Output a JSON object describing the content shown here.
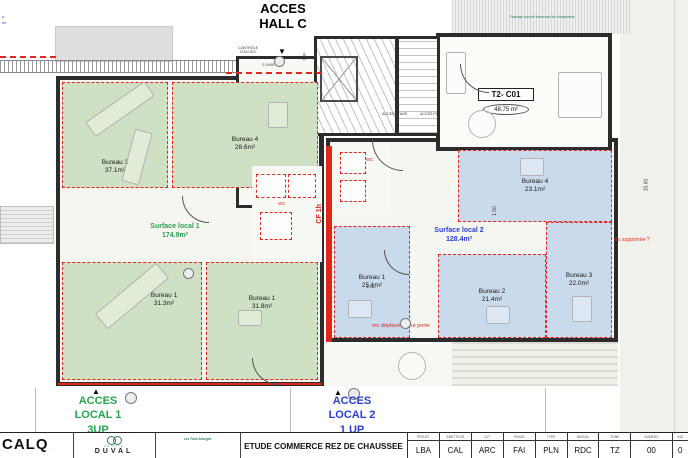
{
  "icons": {
    "down_arrow": "▼",
    "up_arrow": "▲"
  },
  "header": {
    "line1": "ACCES",
    "line2": "HALL C"
  },
  "notes": {
    "corner": [
      "s",
      "rie"
    ],
    "passage": "Passage couvert traversant de chargement"
  },
  "hall": {
    "name": "Hall C",
    "area": "18.68 m²",
    "controle1": "CONTRÔLE",
    "controle2": "D'ACCES",
    "dim": "2.0405",
    "dim_stair": "1.80",
    "acces_etage": "ACCES ETAGE",
    "acces_ph": "ACCES PH"
  },
  "apartment": {
    "name": "T2- C01",
    "area": "48.75 m²"
  },
  "green_local": {
    "surface_name": "Surface local 1",
    "surface_area": "174.9m²",
    "rooms": [
      {
        "name": "Bureau 3",
        "area": "37.1m²"
      },
      {
        "name": "Bureau 4",
        "area": "28.6m²"
      },
      {
        "name": "Bureau 1",
        "area": "31.3m²"
      },
      {
        "name": "Bureau 1",
        "area": "31.8m²"
      }
    ]
  },
  "blue_local": {
    "surface_name": "Surface local 2",
    "surface_area": "128.4m²",
    "rooms": [
      {
        "name": "Bureau 1",
        "area": "25.1m²"
      },
      {
        "name": "Bureau 2",
        "area": "21.4m²"
      },
      {
        "name": "Bureau 3",
        "area": "22.0m²"
      },
      {
        "name": "Bureau 4",
        "area": "23.1m²"
      }
    ]
  },
  "annotations": {
    "wc_left": "WC",
    "wc_right": "WC",
    "cf": "CF 1h",
    "mc_deplacee": "mc déplacée pour porte",
    "mc_supprimee": "mc supprimée ?",
    "dim_150_h": "1.50",
    "dim_150_v": "1.50",
    "dim_1560": "15.60"
  },
  "access": {
    "local1": [
      "ACCES",
      "LOCAL 1",
      "3UP"
    ],
    "local2": [
      "ACCES",
      "LOCAL 2",
      "1 UP"
    ]
  },
  "titleblock": {
    "calq": "CALQ",
    "calq_sub": [
      "· · · · · ·",
      "· · · · · ·"
    ],
    "duval_groupe": "GROUPE",
    "duval": "DUVAL",
    "address": [
      "Les Trois Allorges",
      "· · · · · · · · · ·",
      "· · · · · ·"
    ],
    "title": "ETUDE COMMERCE REZ DE CHAUSSEE",
    "columns": [
      {
        "h": "PROJET",
        "v": "LBA"
      },
      {
        "h": "EMETTEUR",
        "v": "CAL"
      },
      {
        "h": "LOT",
        "v": "ARC"
      },
      {
        "h": "PHASE",
        "v": "FAI"
      },
      {
        "h": "TYPE",
        "v": "PLN"
      },
      {
        "h": "NIVEAU",
        "v": "RDC"
      },
      {
        "h": "ZONE",
        "v": "TZ"
      },
      {
        "h": "NUMERO",
        "v": "00"
      },
      {
        "h": "IND",
        "v": "0"
      }
    ]
  }
}
